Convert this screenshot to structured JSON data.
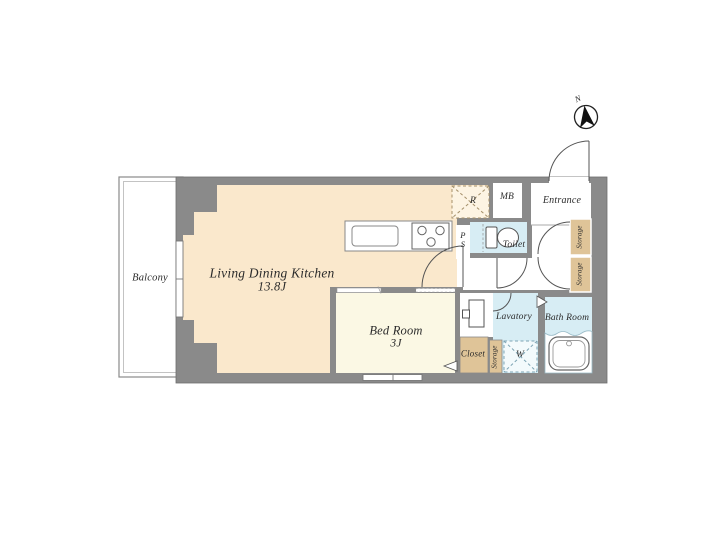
{
  "colors": {
    "wall": "#8A8A8A",
    "ldk_floor": "#FAE8CC",
    "bedroom_floor": "#FBF8E4",
    "wet_area_floor": "#D7EDF4",
    "storage_floor": "#DFC498",
    "background": "#FFFFFF",
    "line": "#555555"
  },
  "compass": {
    "north_label": "N"
  },
  "rooms": {
    "balcony": {
      "label": "Balcony"
    },
    "living_dining_kitchen": {
      "label": "Living Dining Kitchen",
      "size": "13.8J"
    },
    "bed_room": {
      "label": "Bed Room",
      "size": "3J"
    },
    "toilet": {
      "label": "Toilet"
    },
    "meter_box": {
      "label": "MB"
    },
    "entrance": {
      "label": "Entrance"
    },
    "storage_upper": {
      "label": "Storage"
    },
    "storage_lower": {
      "label": "Storage"
    },
    "lavatory": {
      "label": "Lavatory"
    },
    "bath_room": {
      "label": "Bath Room"
    },
    "closet": {
      "label": "Closet"
    },
    "bedroom_storage": {
      "label": "Storage"
    }
  },
  "fixtures": {
    "refrigerator_space": {
      "label": "R"
    },
    "washing_machine_space": {
      "label": "W"
    },
    "pipe_space": {
      "letter1": "P",
      "letter2": "S"
    }
  }
}
